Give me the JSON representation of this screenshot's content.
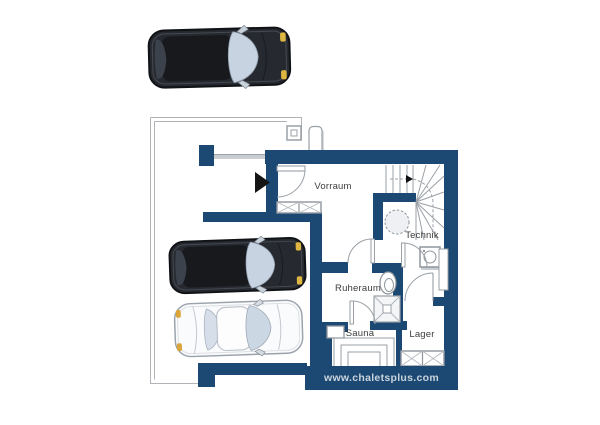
{
  "site": {
    "url": "www.chaletsplus.com"
  },
  "floor_plan": {
    "rooms": [
      {
        "id": "vorraum",
        "label": "Vorraum"
      },
      {
        "id": "technik",
        "label": "Technik"
      },
      {
        "id": "ruheraum",
        "label": "Ruheraum"
      },
      {
        "id": "sauna",
        "label": "Sauna"
      },
      {
        "id": "lager",
        "label": "Lager"
      }
    ],
    "fixtures": [
      "winder-staircase",
      "storage-tank",
      "washing-machine",
      "counter",
      "toilet",
      "shower",
      "sauna-oven",
      "sauna-benches",
      "entry-door",
      "vorraum-windows",
      "lager-windows"
    ],
    "vehicles": [
      {
        "id": "car-top",
        "type": "dark SUV, top view"
      },
      {
        "id": "car-middle",
        "type": "dark SUV, top view"
      },
      {
        "id": "car-bottom",
        "type": "white sedan, top view"
      }
    ]
  },
  "colors": {
    "wall_navy": "#1c4973",
    "outline_gray": "#a9adb3",
    "label_text": "#3c3c3c",
    "footer_text": "#c9d3dc",
    "glass_blue": "#c7d3e1",
    "headlight_yellow": "#ddb741"
  }
}
